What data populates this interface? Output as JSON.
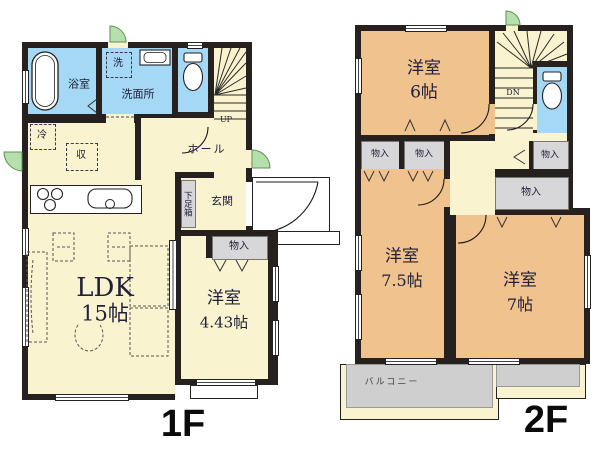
{
  "colors": {
    "wall": "#26211e",
    "room_cream": "#faf3cf",
    "wet_area_blue": "#a5d8f5",
    "bedroom_orange": "#f0c28e",
    "closet_gray": "#d7d7da",
    "balcony_gray": "#cfcfcf",
    "exterior_door_green": "#b5e0ac",
    "label_ink": "#20203a"
  },
  "f1": {
    "floor_label": "1F",
    "bath": "浴室",
    "washroom": "洗面所",
    "laundry": "洗",
    "fridge": "冷",
    "storage": "収",
    "hall": "ホール",
    "up": "UP",
    "shoe_cabinet": "下足箱",
    "entrance": "玄関",
    "closet": "物入",
    "ldk_name": "LDK",
    "ldk_size": "15帖",
    "bedroom_name": "洋室",
    "bedroom_size": "4.43帖"
  },
  "f2": {
    "floor_label": "2F",
    "dn": "DN",
    "bedroom6_name": "洋室",
    "bedroom6_size": "6帖",
    "bedroom75_name": "洋室",
    "bedroom75_size": "7.5帖",
    "bedroom7_name": "洋室",
    "bedroom7_size": "7帖",
    "closet": "物入",
    "balcony": "バルコニー"
  }
}
